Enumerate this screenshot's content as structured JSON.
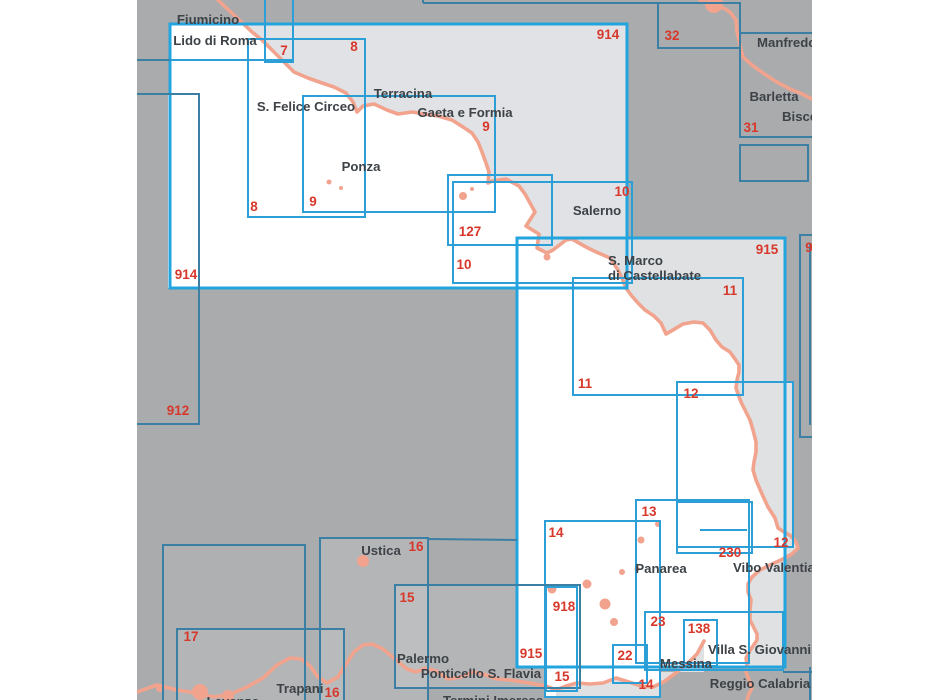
{
  "page": {
    "type": "nautical-chart-index-map",
    "canvas": {
      "width": 950,
      "height": 700
    },
    "viewport": {
      "x": 137,
      "width": 675,
      "height": 700
    }
  },
  "palette": {
    "margin": "#ffffff",
    "map_background": "#a9abad",
    "highlight_land": "#e0e2e5",
    "highlight_land_soft": "#dfe1e3",
    "highlight_sea": "#ffffff",
    "soft_tint": "rgba(255,255,255,0.13)",
    "softer_tint": "rgba(255,255,255,0.07)",
    "coastline": "#f1a38e",
    "border_bright": "#2b9fd6",
    "border_big": "#22a4df",
    "border_dark": "#3b7fa4",
    "chart_number_red": "#d8382b",
    "place_label_color": "#3d4247"
  },
  "chart_rects": [
    {
      "id": "914",
      "x": 170,
      "y": 24,
      "w": 457,
      "h": 264,
      "style": "big",
      "labels": [
        {
          "text": "914",
          "x": 608,
          "y": 39
        },
        {
          "text": "914",
          "x": 186,
          "y": 279
        }
      ]
    },
    {
      "id": "7",
      "x": 265,
      "y": -16,
      "w": 28,
      "h": 78,
      "style": "bright",
      "labels": [
        {
          "text": "7",
          "x": 284,
          "y": 55
        }
      ]
    },
    {
      "id": "8",
      "x": 248,
      "y": 39,
      "w": 117,
      "h": 178,
      "style": "bright",
      "labels": [
        {
          "text": "8",
          "x": 354,
          "y": 51
        },
        {
          "text": "8",
          "x": 254,
          "y": 211
        }
      ]
    },
    {
      "id": "9",
      "x": 303,
      "y": 96,
      "w": 192,
      "h": 116,
      "style": "bright",
      "labels": [
        {
          "text": "9",
          "x": 486,
          "y": 131
        },
        {
          "text": "9",
          "x": 313,
          "y": 206
        }
      ]
    },
    {
      "id": "127",
      "x": 448,
      "y": 175,
      "w": 104,
      "h": 70,
      "style": "bright",
      "labels": [
        {
          "text": "127",
          "x": 470,
          "y": 236
        }
      ]
    },
    {
      "id": "10",
      "x": 453,
      "y": 182,
      "w": 179,
      "h": 101,
      "style": "bright",
      "labels": [
        {
          "text": "10",
          "x": 622,
          "y": 196
        },
        {
          "text": "10",
          "x": 464,
          "y": 269
        }
      ]
    },
    {
      "id": "912",
      "x": 60,
      "y": 94,
      "w": 139,
      "h": 330,
      "style": "dark",
      "labels": [
        {
          "text": "912",
          "x": 178,
          "y": 415
        }
      ]
    },
    {
      "id": "32",
      "x": 658,
      "y": 3,
      "w": 82,
      "h": 45,
      "style": "dark",
      "labels": [
        {
          "text": "32",
          "x": 672,
          "y": 40
        }
      ]
    },
    {
      "id": "31",
      "x": 740,
      "y": 33,
      "w": 140,
      "h": 104,
      "style": "dark",
      "labels": [
        {
          "text": "31",
          "x": 751,
          "y": 132
        }
      ]
    },
    {
      "id": "31b",
      "x": 740,
      "y": 145,
      "w": 68,
      "h": 36,
      "style": "dark",
      "labels": []
    },
    {
      "id": "915",
      "x": 517,
      "y": 238,
      "w": 268,
      "h": 429,
      "style": "big",
      "labels": [
        {
          "text": "915",
          "x": 767,
          "y": 254
        },
        {
          "text": "915",
          "x": 531,
          "y": 658
        }
      ]
    },
    {
      "id": "916",
      "x": 800,
      "y": 235,
      "w": 95,
      "h": 202,
      "style": "dark",
      "labels": [
        {
          "text": "9",
          "x": 809,
          "y": 252
        }
      ]
    },
    {
      "id": "11",
      "x": 573,
      "y": 278,
      "w": 170,
      "h": 117,
      "style": "bright",
      "labels": [
        {
          "text": "11",
          "x": 730,
          "y": 295
        },
        {
          "text": "11",
          "x": 585,
          "y": 388
        }
      ]
    },
    {
      "id": "12",
      "x": 677,
      "y": 382,
      "w": 116,
      "h": 165,
      "style": "bright",
      "labels": [
        {
          "text": "12",
          "x": 691,
          "y": 398
        },
        {
          "text": "12",
          "x": 781,
          "y": 547
        }
      ]
    },
    {
      "id": "13",
      "x": 636,
      "y": 500,
      "w": 113,
      "h": 163,
      "style": "bright",
      "labels": [
        {
          "text": "13",
          "x": 649,
          "y": 516
        }
      ]
    },
    {
      "id": "230",
      "x": 677,
      "y": 502,
      "w": 75,
      "h": 51,
      "style": "bright",
      "labels": [
        {
          "text": "230",
          "x": 730,
          "y": 557
        }
      ]
    },
    {
      "id": "14",
      "x": 545,
      "y": 521,
      "w": 115,
      "h": 176,
      "style": "bright",
      "labels": [
        {
          "text": "14",
          "x": 556,
          "y": 537
        },
        {
          "text": "14",
          "x": 646,
          "y": 689
        }
      ]
    },
    {
      "id": "16",
      "x": 320,
      "y": 538,
      "w": 108,
      "h": 167,
      "style": "dark",
      "labels": [
        {
          "text": "16",
          "x": 416,
          "y": 551
        },
        {
          "text": "16",
          "x": 332,
          "y": 697
        }
      ]
    },
    {
      "id": "15",
      "x": 395,
      "y": 585,
      "w": 185,
      "h": 103,
      "style": "dark",
      "labels": [
        {
          "text": "15",
          "x": 407,
          "y": 602
        },
        {
          "text": "15",
          "x": 562,
          "y": 681
        }
      ]
    },
    {
      "id": "918",
      "x": 546,
      "y": 587,
      "w": 31,
      "h": 104,
      "style": "bright",
      "labels": [
        {
          "text": "918",
          "x": 564,
          "y": 611
        }
      ]
    },
    {
      "id": "17",
      "x": 177,
      "y": 629,
      "w": 167,
      "h": 85,
      "style": "dark",
      "labels": [
        {
          "text": "17",
          "x": 191,
          "y": 641
        }
      ]
    },
    {
      "id": "A",
      "x": 163,
      "y": 545,
      "w": 142,
      "h": 170,
      "style": "dark",
      "labels": []
    },
    {
      "id": "23",
      "x": 645,
      "y": 612,
      "w": 138,
      "h": 58,
      "style": "bright",
      "labels": [
        {
          "text": "23",
          "x": 658,
          "y": 626
        }
      ]
    },
    {
      "id": "22",
      "x": 613,
      "y": 645,
      "w": 34,
      "h": 38,
      "style": "bright",
      "labels": [
        {
          "text": "22",
          "x": 625,
          "y": 660
        }
      ]
    },
    {
      "id": "138",
      "x": 684,
      "y": 620,
      "w": 33,
      "h": 46,
      "style": "bright",
      "labels": [
        {
          "text": "138",
          "x": 699,
          "y": 633
        }
      ]
    }
  ],
  "border_segments": [
    {
      "x1": 137,
      "y1": 60,
      "x2": 170,
      "y2": 60,
      "style": "dark"
    },
    {
      "x1": 170,
      "y1": 60,
      "x2": 293,
      "y2": 60,
      "style": "bright"
    },
    {
      "x1": 423,
      "y1": 3,
      "x2": 658,
      "y2": 3,
      "style": "dark"
    },
    {
      "x1": 423,
      "y1": 0,
      "x2": 423,
      "y2": 3,
      "style": "dark"
    },
    {
      "x1": 428,
      "y1": 539,
      "x2": 517,
      "y2": 540,
      "style": "dark"
    },
    {
      "x1": 700,
      "y1": 530,
      "x2": 747,
      "y2": 530,
      "style": "bright"
    },
    {
      "x1": 783,
      "y1": 672,
      "x2": 812,
      "y2": 672,
      "style": "dark"
    },
    {
      "x1": 810,
      "y1": 667,
      "x2": 810,
      "y2": 700,
      "style": "dark"
    },
    {
      "x1": 810,
      "y1": 243,
      "x2": 810,
      "y2": 425,
      "style": "dark"
    }
  ],
  "place_labels": [
    {
      "text": "Fiumicino",
      "x": 208,
      "y": 24,
      "anchor": "middle"
    },
    {
      "text": "Lido di Roma",
      "x": 215,
      "y": 45,
      "anchor": "middle"
    },
    {
      "text": "S. Felice Circeo",
      "x": 306,
      "y": 111,
      "anchor": "middle"
    },
    {
      "text": "Terracina",
      "x": 403,
      "y": 98,
      "anchor": "middle"
    },
    {
      "text": "Gaeta e Formia",
      "x": 465,
      "y": 117,
      "anchor": "middle"
    },
    {
      "text": "Ponza",
      "x": 361,
      "y": 171,
      "anchor": "middle"
    },
    {
      "text": "Salerno",
      "x": 597,
      "y": 215,
      "anchor": "middle"
    },
    {
      "text": "S. Marco",
      "x": 608,
      "y": 265,
      "anchor": "start"
    },
    {
      "text": "di Castellabate",
      "x": 608,
      "y": 280,
      "anchor": "start"
    },
    {
      "text": "Manfredonia",
      "x": 757,
      "y": 47,
      "anchor": "start"
    },
    {
      "text": "Barletta",
      "x": 774,
      "y": 101,
      "anchor": "middle"
    },
    {
      "text": "Bisceglie",
      "x": 782,
      "y": 121,
      "anchor": "start"
    },
    {
      "text": "Ustica",
      "x": 381,
      "y": 555,
      "anchor": "middle"
    },
    {
      "text": "Panarea",
      "x": 661,
      "y": 573,
      "anchor": "middle"
    },
    {
      "text": "Vibo Valentia",
      "x": 733,
      "y": 572,
      "anchor": "start"
    },
    {
      "text": "Palermo",
      "x": 423,
      "y": 663,
      "anchor": "middle"
    },
    {
      "text": "Ponticello S. Flavia",
      "x": 481,
      "y": 678,
      "anchor": "middle"
    },
    {
      "text": "Villa S. Giovanni",
      "x": 708,
      "y": 654,
      "anchor": "start"
    },
    {
      "text": "Messina",
      "x": 686,
      "y": 668,
      "anchor": "middle"
    },
    {
      "text": "Reggio Calabria",
      "x": 760,
      "y": 688,
      "anchor": "middle"
    },
    {
      "text": "Trapani",
      "x": 300,
      "y": 693,
      "anchor": "middle"
    },
    {
      "text": "Levanzo",
      "x": 233,
      "y": 706,
      "anchor": "middle"
    },
    {
      "text": "Termini Imerese",
      "x": 443,
      "y": 705,
      "anchor": "start"
    }
  ]
}
